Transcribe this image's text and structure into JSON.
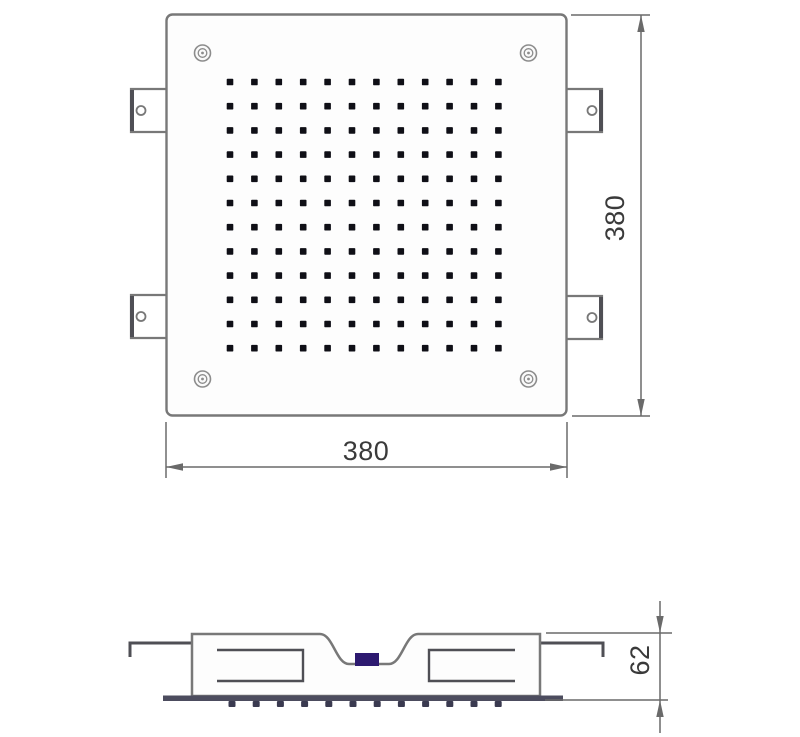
{
  "drawing": {
    "type": "technical-dimension-drawing",
    "subject": "square-ceiling-shower-head",
    "dimensions": {
      "width": {
        "label": "380"
      },
      "height": {
        "label": "380"
      },
      "depth": {
        "label": "62"
      }
    },
    "nozzle_grid": {
      "rows": 12,
      "cols": 12
    },
    "side_nozzles": {
      "count": 12
    },
    "colors": {
      "line": "#787878",
      "line_dark": "#4f4f55",
      "dimension": "#6a6a6a",
      "text": "#3a3a3a",
      "nozzle_dot": "#0f0f16",
      "baseplate": "#4c4c5e",
      "side_nozzle": "#3a3a50",
      "inlet_connector": "#2d1a70",
      "screw": "#8c8c8c",
      "bg": "#ffffff"
    }
  }
}
